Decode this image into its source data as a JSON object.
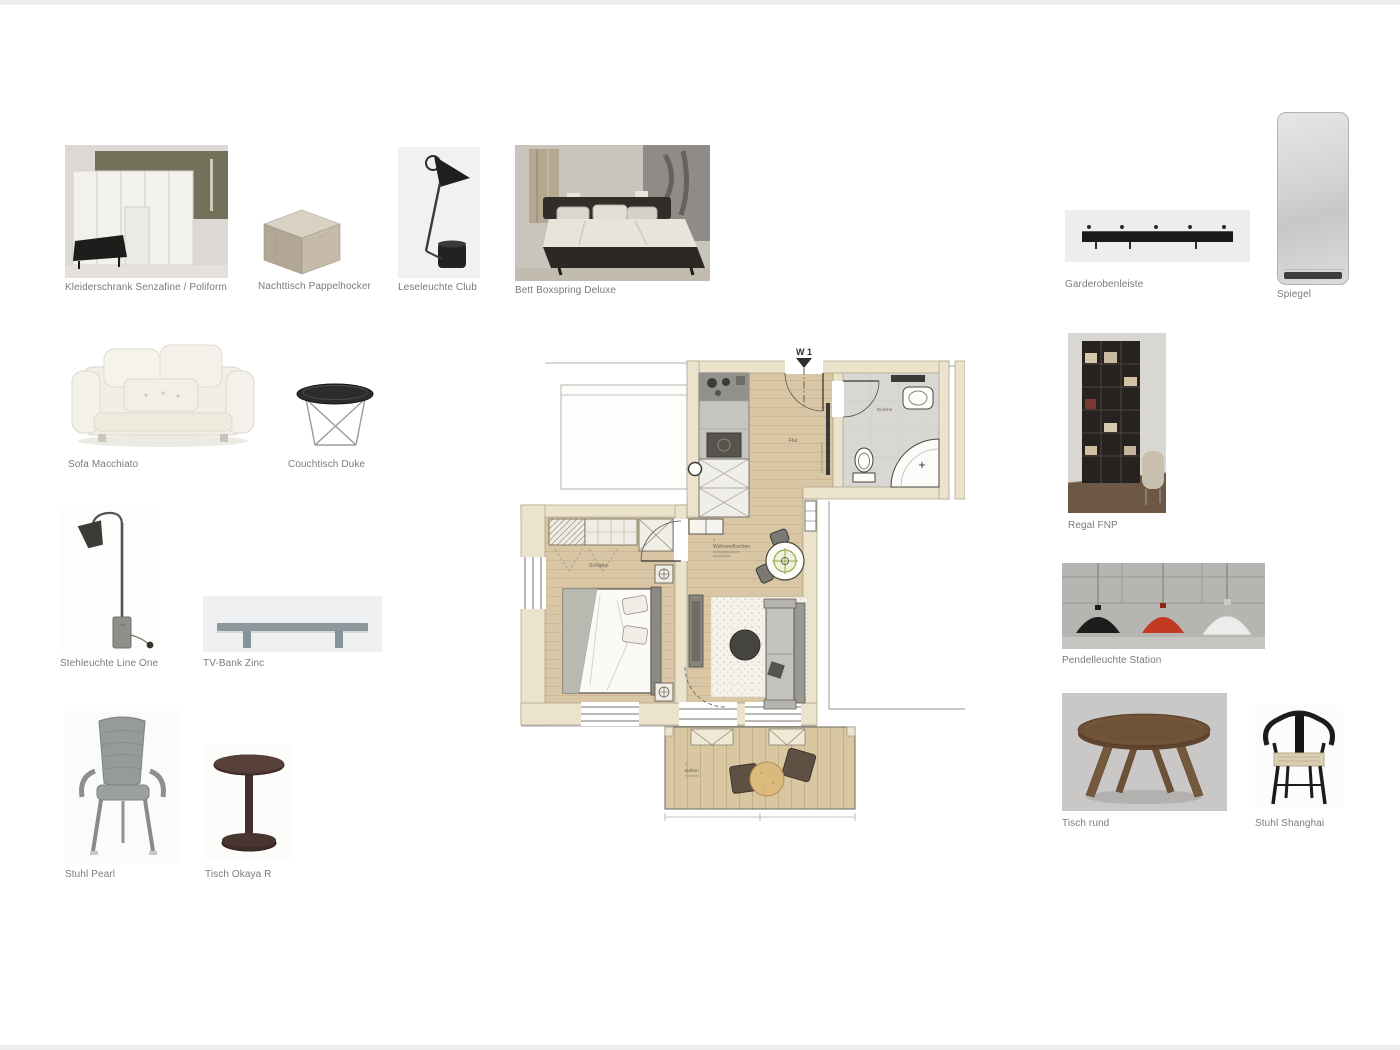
{
  "board": {
    "background": "#ffffff",
    "description_labels": true
  },
  "items": [
    {
      "id": "kleiderschrank",
      "label": "Kleiderschrank Senzafine / Poliform"
    },
    {
      "id": "nachttisch",
      "label": "Nachttisch Pappelhocker"
    },
    {
      "id": "leseleuchte",
      "label": "Leseleuchte Club"
    },
    {
      "id": "bett",
      "label": "Bett Boxspring Deluxe"
    },
    {
      "id": "garderobenleiste",
      "label": "Garderobenleiste"
    },
    {
      "id": "spiegel",
      "label": "Spiegel"
    },
    {
      "id": "sofa",
      "label": "Sofa Macchiato"
    },
    {
      "id": "couchtisch",
      "label": "Couchtisch Duke"
    },
    {
      "id": "stehleuchte",
      "label": "Stehleuchte Line One"
    },
    {
      "id": "tvbank",
      "label": "TV-Bank Zinc"
    },
    {
      "id": "stuhl-pearl",
      "label": "Stuhl Pearl"
    },
    {
      "id": "tisch-okaya",
      "label": "Tisch Okaya R"
    },
    {
      "id": "regal",
      "label": "Regal FNP"
    },
    {
      "id": "pendelleuchte",
      "label": "Pendelleuchte Station"
    },
    {
      "id": "tisch-rund",
      "label": "Tisch rund"
    },
    {
      "id": "stuhl-shanghai",
      "label": "Stuhl Shanghai"
    }
  ],
  "floorplan": {
    "unit_label": "W 1",
    "rooms": {
      "bedroom": "Schlafen",
      "living": "Wohnen/Kochen",
      "hall": "Flur",
      "bath": "Dusche",
      "balcony": "Balkon"
    },
    "room_numbers": {
      "living": "1",
      "balcony": "2"
    },
    "coatrail_label": "Garderobenleiste"
  },
  "colors": {
    "wood_floor": "#d9c6a5",
    "wall_fill": "#ebe3cc",
    "bath_floor": "#d8d7d3",
    "balcony_floor": "#d9c7a2",
    "caption_text": "#7b7b78",
    "pendant_red": "#c23a22",
    "lamp_symbol_green": "#9aa94f"
  }
}
